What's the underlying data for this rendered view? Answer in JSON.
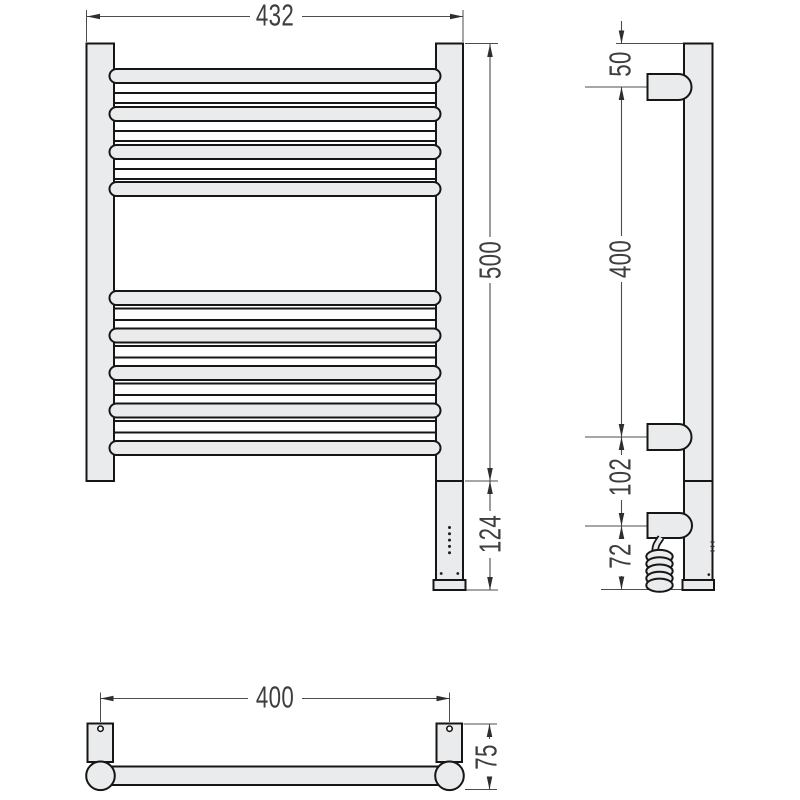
{
  "front_view": {
    "labels": {
      "overall_width": "432",
      "height": "500",
      "heater_section": "124"
    }
  },
  "side_view": {
    "labels": {
      "top_to_upper_bracket": "50",
      "bracket_spacing": "400",
      "lower_bracket_to_power_box": "102",
      "power_box_to_bottom": "72"
    }
  },
  "bottom_view": {
    "labels": {
      "mounting_centers": "400",
      "wall_offset": "75"
    }
  },
  "colors": {
    "background": "#ffffff",
    "metal_fill": "#e9ebec",
    "outline": "#161616",
    "dimension_lines": "#4c4c4c",
    "label_text": "#3e3e3e"
  }
}
